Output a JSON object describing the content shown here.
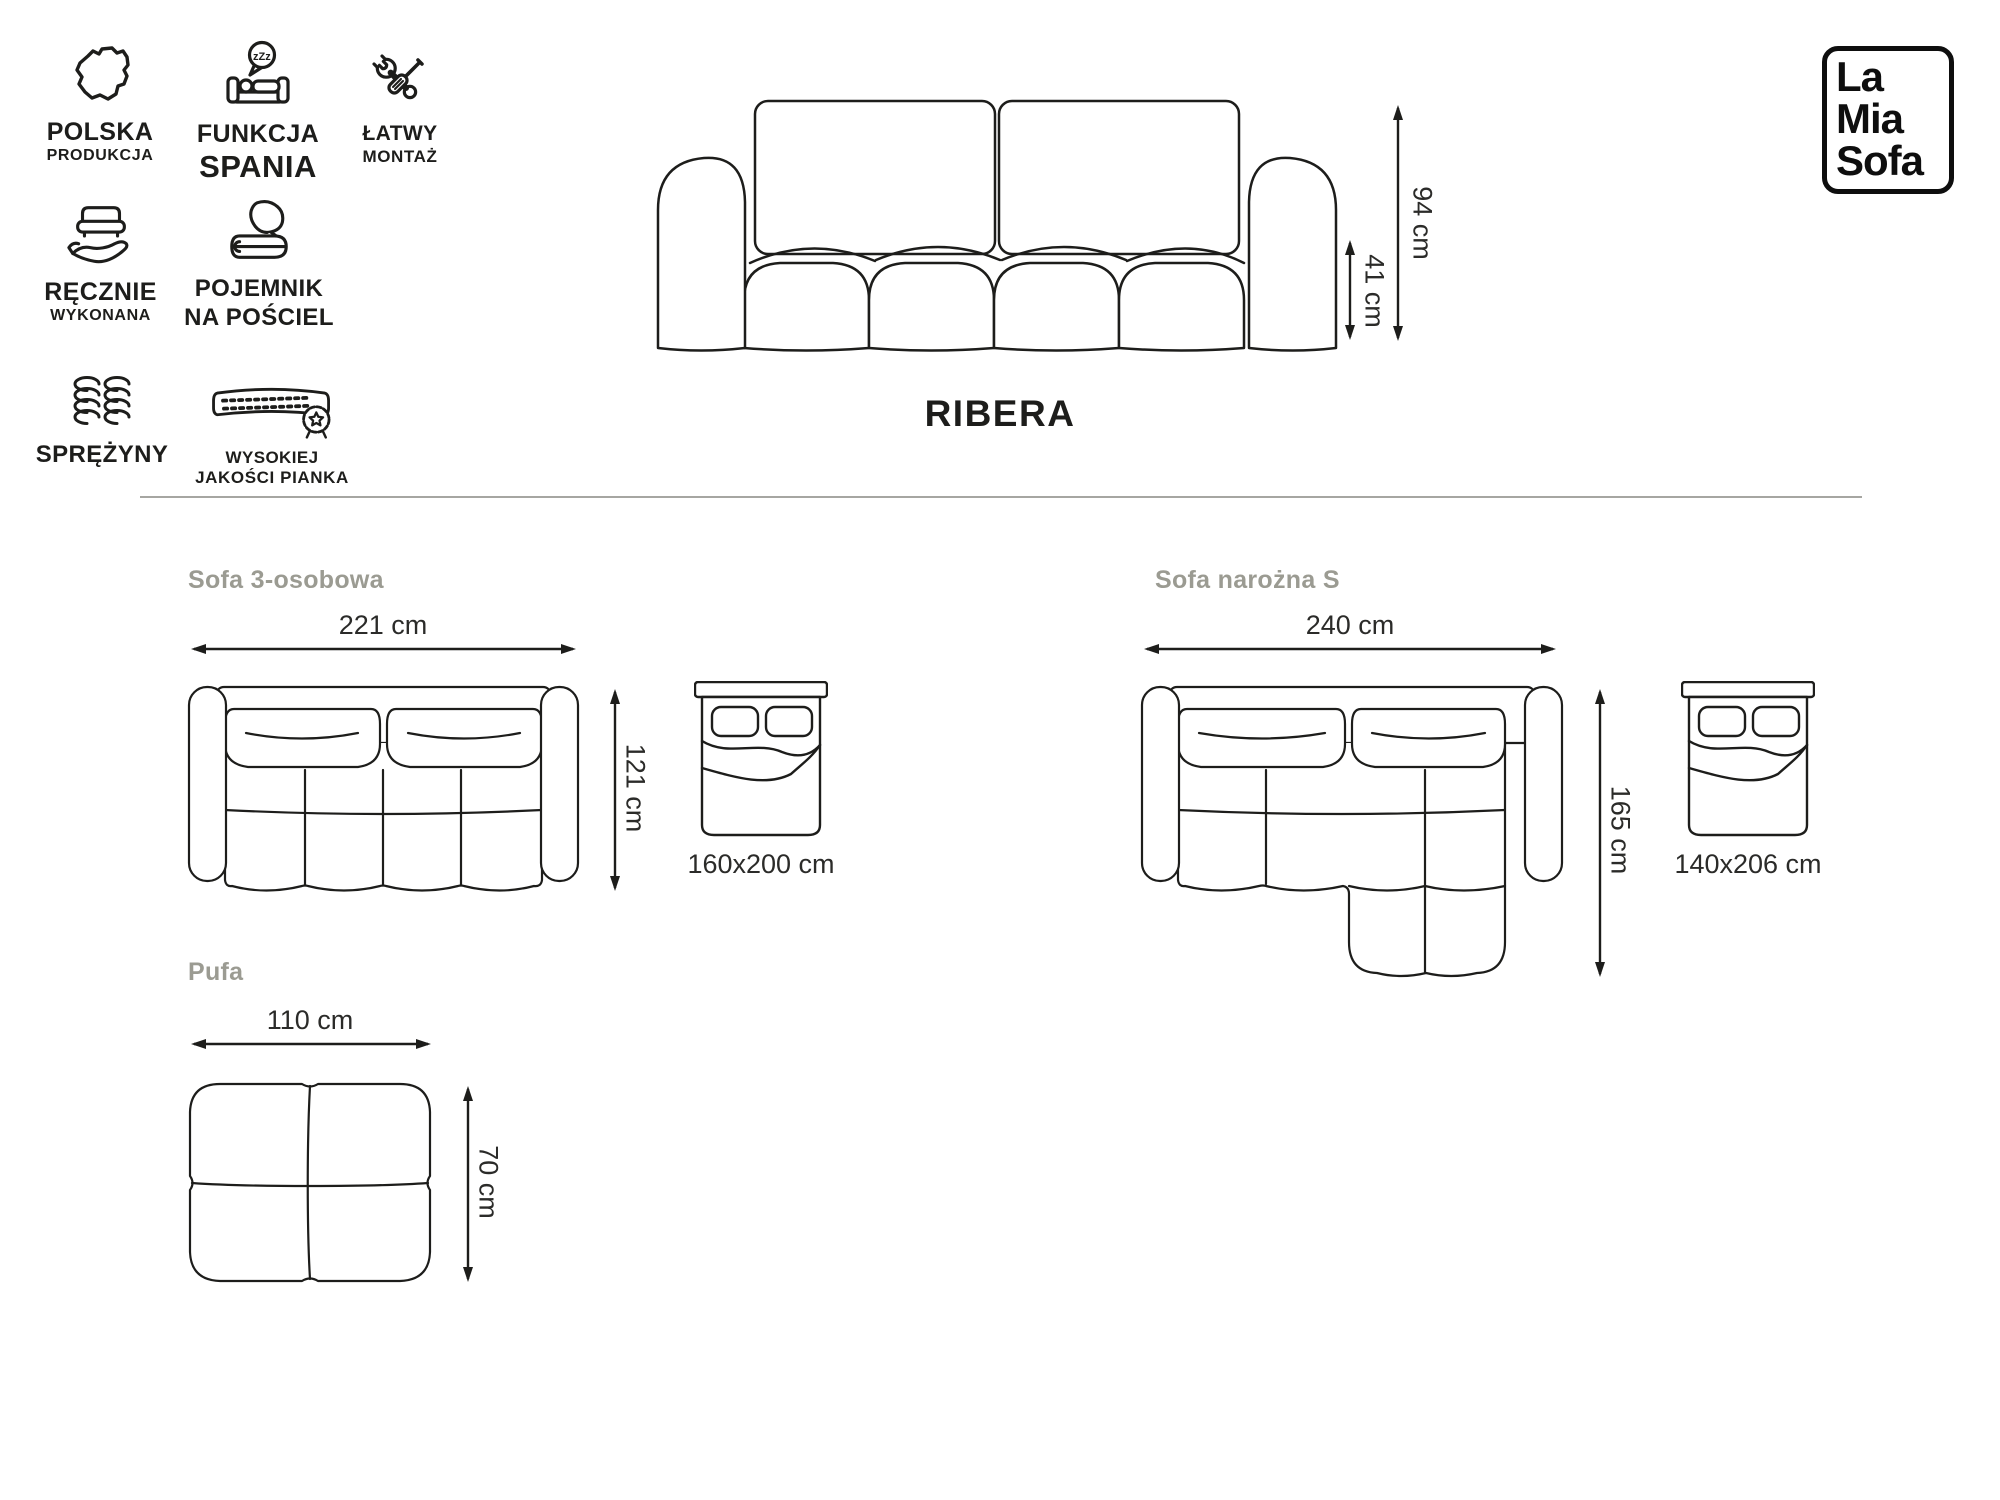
{
  "features": [
    {
      "icon": "poland-map-icon",
      "line1": "POLSKA",
      "line2": "PRODUKCJA"
    },
    {
      "icon": "sleep-function-icon",
      "line1": "FUNKCJA",
      "line2": "SPANIA",
      "zzz": "zZz"
    },
    {
      "icon": "easy-assembly-icon",
      "line1": "ŁATWY",
      "line2": "MONTAŻ"
    },
    {
      "icon": "handmade-icon",
      "line1": "RĘCZNIE",
      "line2": "WYKONANA"
    },
    {
      "icon": "bedding-storage-icon",
      "line1": "POJEMNIK",
      "line2": "NA POŚCIEL"
    },
    {
      "icon": "springs-icon",
      "line1": "SPRĘŻYNY"
    },
    {
      "icon": "foam-quality-icon",
      "line1": "WYSOKIEJ",
      "line2": "JAKOŚCI PIANKA"
    }
  ],
  "product": {
    "name": "RIBERA",
    "height_label": "94 cm",
    "seat_height_label": "41 cm"
  },
  "logo": {
    "line1": "La",
    "line2": "Mia",
    "line3": "Sofa"
  },
  "sections": {
    "three_seater": {
      "title": "Sofa 3-osobowa",
      "width_label": "221 cm",
      "depth_label": "121 cm",
      "bed_size_label": "160x200 cm"
    },
    "corner_sofa": {
      "title": "Sofa narożna S",
      "width_label": "240 cm",
      "depth_label": "165 cm",
      "bed_size_label": "140x206 cm"
    },
    "pouf": {
      "title": "Pufa",
      "width_label": "110 cm",
      "depth_label": "70 cm"
    }
  },
  "colors": {
    "line_art": "#1d1d1b",
    "section_heading": "#9b9b92",
    "dimension_text": "#2b2b29",
    "divider": "#a6a6a2",
    "background": "#ffffff"
  }
}
